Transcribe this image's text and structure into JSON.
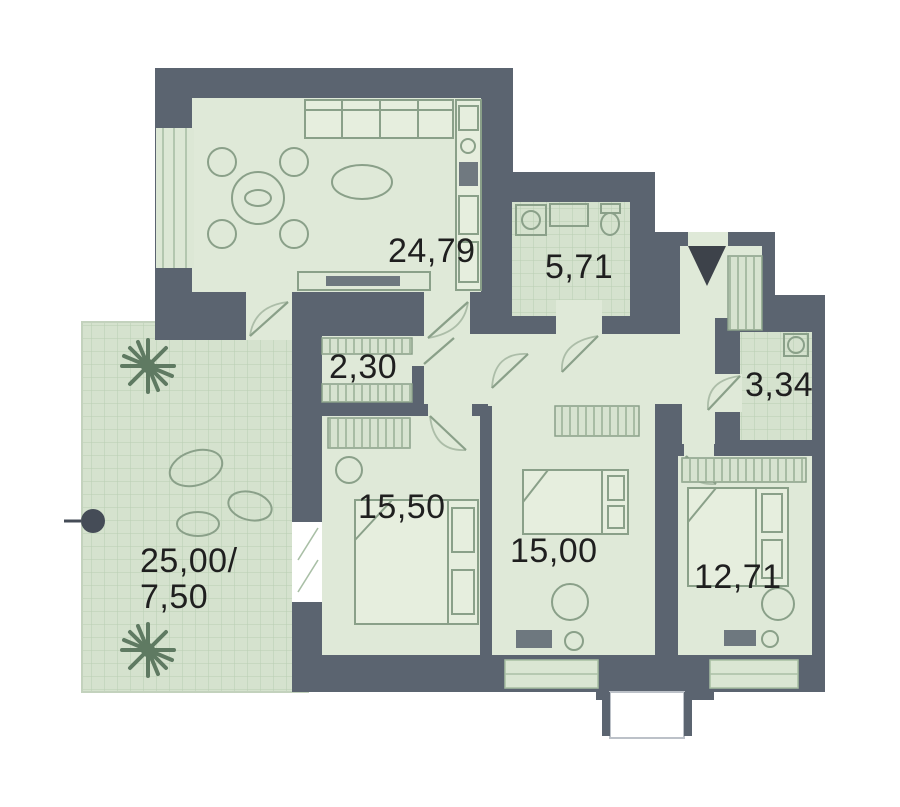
{
  "plan_type": "apartment-floor-plan",
  "rooms": [
    {
      "id": "living-room",
      "area": "24,79"
    },
    {
      "id": "bathroom",
      "area": "5,71"
    },
    {
      "id": "closet",
      "area": "2,30"
    },
    {
      "id": "wc",
      "area": "3,34"
    },
    {
      "id": "bedroom-1",
      "area": "15,50"
    },
    {
      "id": "bedroom-2",
      "area": "15,00"
    },
    {
      "id": "bedroom-3",
      "area": "12,71"
    },
    {
      "id": "terrace",
      "area_line1": "25,00/",
      "area_line2": "7,50"
    }
  ],
  "markers": {
    "entrance_icon": "triangle-down",
    "section_marker_icon": "filled-circle"
  },
  "colors": {
    "wall": "#5b6470",
    "floor": "#dfe9d8",
    "floor_tile": "#d5e2ce",
    "tile_line": "#b9ceb3",
    "furniture_line": "#8aa089",
    "label_text": "#1f1f1f",
    "background": "#ffffff",
    "terrace_plant": "#5f7a62",
    "marker": "#454c57",
    "entrance": "#3d424a"
  }
}
